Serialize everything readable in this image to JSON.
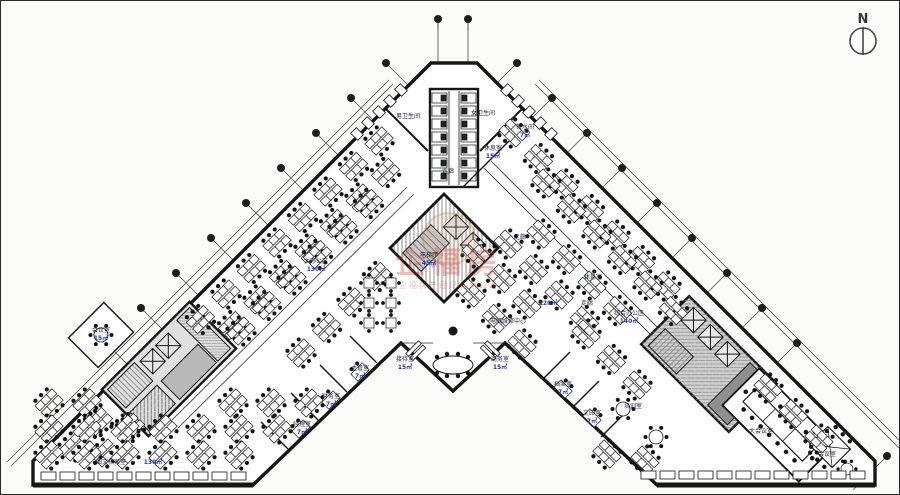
{
  "page": {
    "background": "#fbfbfa",
    "border_color": "#2a2a2a"
  },
  "north_arrow": {
    "label": "N",
    "color": "#33343a"
  },
  "watermark": {
    "line1": "企福房",
    "line2": "企福房产经纪有限公司",
    "color": "#c43a32"
  },
  "colors": {
    "wall": "#161616",
    "room_label": "#16213f",
    "area_value": "#2233bb",
    "hatch": "#8f8f8f",
    "core_fill": "#d6d6d6"
  },
  "labels": [
    {
      "t": "男卫生间",
      "x": 407,
      "y": 117,
      "c": "d"
    },
    {
      "t": "女卫生间",
      "x": 482,
      "y": 114,
      "c": "d"
    },
    {
      "t": "休息室",
      "x": 492,
      "y": 149,
      "c": "d"
    },
    {
      "t": "15㎡",
      "x": 492,
      "y": 157,
      "c": "b"
    },
    {
      "t": "茶水间",
      "x": 524,
      "y": 128,
      "c": "d"
    },
    {
      "t": "7㎡",
      "x": 524,
      "y": 136,
      "c": "b"
    },
    {
      "t": "走廊",
      "x": 447,
      "y": 172,
      "c": "d"
    },
    {
      "t": "电梯厅",
      "x": 428,
      "y": 256,
      "c": "d"
    },
    {
      "t": "45㎡",
      "x": 428,
      "y": 264,
      "c": "b"
    },
    {
      "t": "走廊",
      "x": 519,
      "y": 238,
      "c": "d"
    },
    {
      "t": "大办公区",
      "x": 315,
      "y": 262,
      "c": "d"
    },
    {
      "t": "130㎡",
      "x": 315,
      "y": 270,
      "c": "b"
    },
    {
      "t": "休息室",
      "x": 592,
      "y": 278,
      "c": "d"
    },
    {
      "t": "走廊",
      "x": 586,
      "y": 304,
      "c": "d"
    },
    {
      "t": "综合办公区",
      "x": 628,
      "y": 314,
      "c": "d"
    },
    {
      "t": "140㎡",
      "x": 628,
      "y": 322,
      "c": "b"
    },
    {
      "t": "电脑维修中心",
      "x": 507,
      "y": 322,
      "c": "d"
    },
    {
      "t": "120㎡",
      "x": 547,
      "y": 304,
      "c": "b"
    },
    {
      "t": "接待室",
      "x": 404,
      "y": 360,
      "c": "d"
    },
    {
      "t": "15㎡",
      "x": 404,
      "y": 368,
      "c": "b"
    },
    {
      "t": "商务室",
      "x": 499,
      "y": 360,
      "c": "d"
    },
    {
      "t": "15㎡",
      "x": 499,
      "y": 368,
      "c": "b"
    },
    {
      "t": "会议室",
      "x": 100,
      "y": 331,
      "c": "d"
    },
    {
      "t": "15㎡",
      "x": 100,
      "y": 339,
      "c": "b"
    },
    {
      "t": "经理室",
      "x": 301,
      "y": 425,
      "c": "d"
    },
    {
      "t": "7㎡",
      "x": 301,
      "y": 433,
      "c": "b"
    },
    {
      "t": "财务室",
      "x": 330,
      "y": 397,
      "c": "d"
    },
    {
      "t": "7㎡",
      "x": 330,
      "y": 405,
      "c": "b"
    },
    {
      "t": "主管室",
      "x": 359,
      "y": 369,
      "c": "d"
    },
    {
      "t": "7㎡",
      "x": 359,
      "y": 377,
      "c": "b"
    },
    {
      "t": "档案室",
      "x": 562,
      "y": 385,
      "c": "d"
    },
    {
      "t": "7㎡",
      "x": 562,
      "y": 393,
      "c": "b"
    },
    {
      "t": "文印室",
      "x": 591,
      "y": 414,
      "c": "d"
    },
    {
      "t": "7㎡",
      "x": 591,
      "y": 422,
      "c": "b"
    },
    {
      "t": "培训室",
      "x": 632,
      "y": 407,
      "c": "d"
    },
    {
      "t": "大会议室",
      "x": 760,
      "y": 432,
      "c": "d"
    },
    {
      "t": "会议室",
      "x": 826,
      "y": 455,
      "c": "d"
    },
    {
      "t": "图文档案室",
      "x": 110,
      "y": 463,
      "c": "d"
    },
    {
      "t": "130㎡",
      "x": 152,
      "y": 463,
      "c": "b"
    }
  ]
}
